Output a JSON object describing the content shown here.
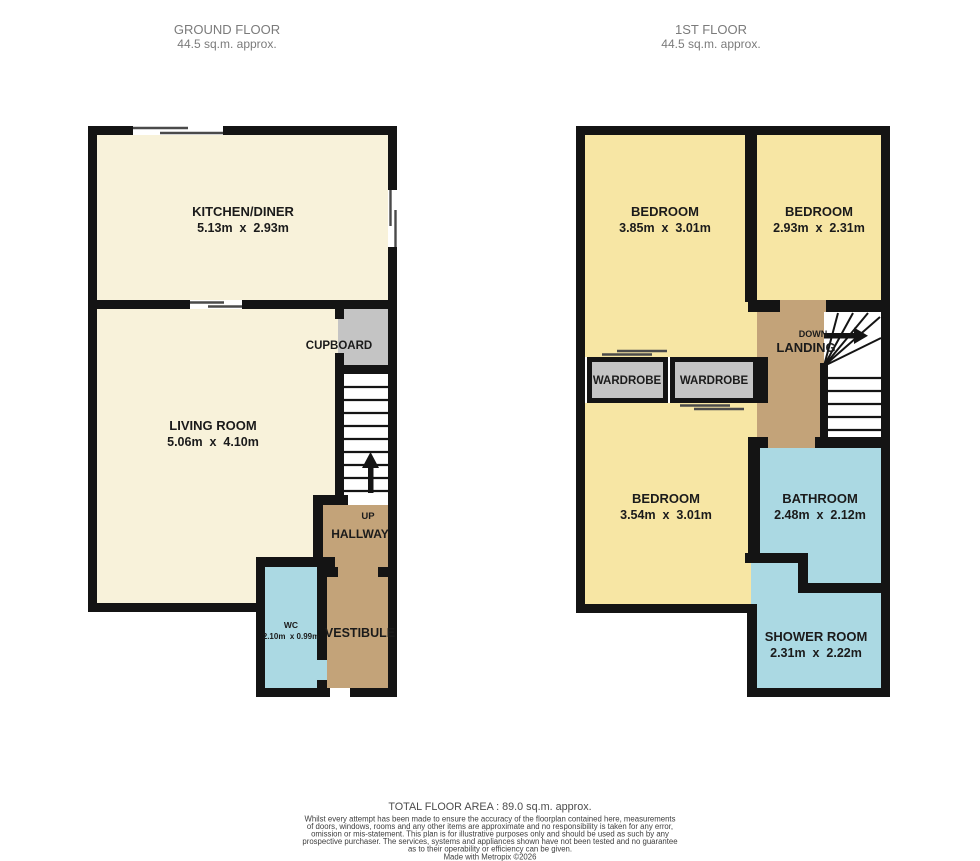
{
  "headers": {
    "ground": {
      "title": "GROUND FLOOR",
      "area": "44.5 sq.m. approx."
    },
    "first": {
      "title": "1ST FLOOR",
      "area": "44.5 sq.m. approx."
    }
  },
  "colors": {
    "wall": "#141414",
    "window_line": "#4a4a4a",
    "room_cream": "#f8f2da",
    "room_yellow": "#f7e6a4",
    "room_tan": "#c3a379",
    "room_blue": "#abd9e3",
    "room_gray": "#c4c4c4",
    "label_text": "#1b1b1b",
    "header_text": "#7b7b7b",
    "footer_total_text": "#4c4c4c",
    "footer_text": "#3e3e3e"
  },
  "ground_floor": {
    "kitchen": {
      "name": "KITCHEN/DINER",
      "dims": "5.13m  x  2.93m"
    },
    "living": {
      "name": "LIVING ROOM",
      "dims": "5.06m  x  4.10m"
    },
    "cupboard": {
      "name": "CUPBOARD"
    },
    "stairs": {
      "direction_label": "UP"
    },
    "hallway": {
      "name": "HALLWAY"
    },
    "wc": {
      "name": "WC",
      "dims": "2.10m  x 0.99m"
    },
    "vestibule": {
      "name": "VESTIBULE"
    }
  },
  "first_floor": {
    "bedroom1": {
      "name": "BEDROOM",
      "dims": "3.85m  x  3.01m"
    },
    "bedroom2": {
      "name": "BEDROOM",
      "dims": "2.93m  x  2.31m"
    },
    "bedroom3": {
      "name": "BEDROOM",
      "dims": "3.54m  x  3.01m"
    },
    "landing": {
      "name": "LANDING",
      "direction_label": "DOWN"
    },
    "wardrobe_left": {
      "name": "WARDROBE"
    },
    "wardrobe_right": {
      "name": "WARDROBE"
    },
    "bathroom": {
      "name": "BATHROOM",
      "dims": "2.48m  x  2.12m"
    },
    "shower": {
      "name": "SHOWER ROOM",
      "dims": "2.31m  x  2.22m"
    }
  },
  "footer": {
    "total_area": "TOTAL FLOOR AREA : 89.0 sq.m. approx.",
    "disclaimer_lines": [
      "Whilst every attempt has been made to ensure the accuracy of the floorplan contained here, measurements",
      "of doors, windows, rooms and any other items are approximate and no responsibility is taken for any error,",
      "omission or mis-statement. This plan is for illustrative purposes only and should be used as such by any",
      "prospective purchaser. The services, systems and appliances shown have not been tested and no guarantee",
      "as to their operability or efficiency can be given."
    ],
    "credit": "Made with Metropix ©2026"
  }
}
